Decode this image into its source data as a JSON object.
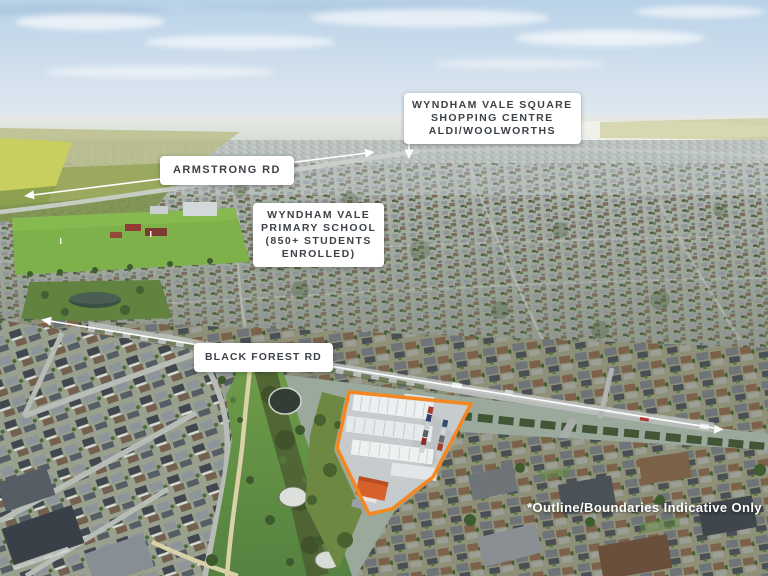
{
  "scene": {
    "type": "aerial-photo",
    "description": "Aerial view of Wyndham Vale suburb with real-estate callout labels and an outlined subject site"
  },
  "callouts": {
    "shopping_centre": {
      "lines": [
        "WYNDHAM VALE SQUARE",
        "SHOPPING CENTRE",
        "ALDI/WOOLWORTHS"
      ]
    },
    "armstrong_rd": {
      "label": "ARMSTRONG RD"
    },
    "primary_school": {
      "lines": [
        "WYNDHAM VALE",
        "PRIMARY SCHOOL",
        "(850+ STUDENTS",
        "ENROLLED)"
      ]
    },
    "black_forest_rd": {
      "label": "BLACK FOREST RD"
    },
    "disclaimer": "*Outline/Boundaries Indicative Only"
  },
  "icons": {
    "arrow_left": "left-pointing road arrow",
    "arrow_right": "right-pointing road arrow",
    "arrow_down": "down-pointing callout arrow"
  },
  "colors": {
    "site_outline": "#F6861F",
    "callout_bg": "#FFFFFF",
    "callout_text": "#3C4247",
    "annotation": "#FFFFFF"
  }
}
